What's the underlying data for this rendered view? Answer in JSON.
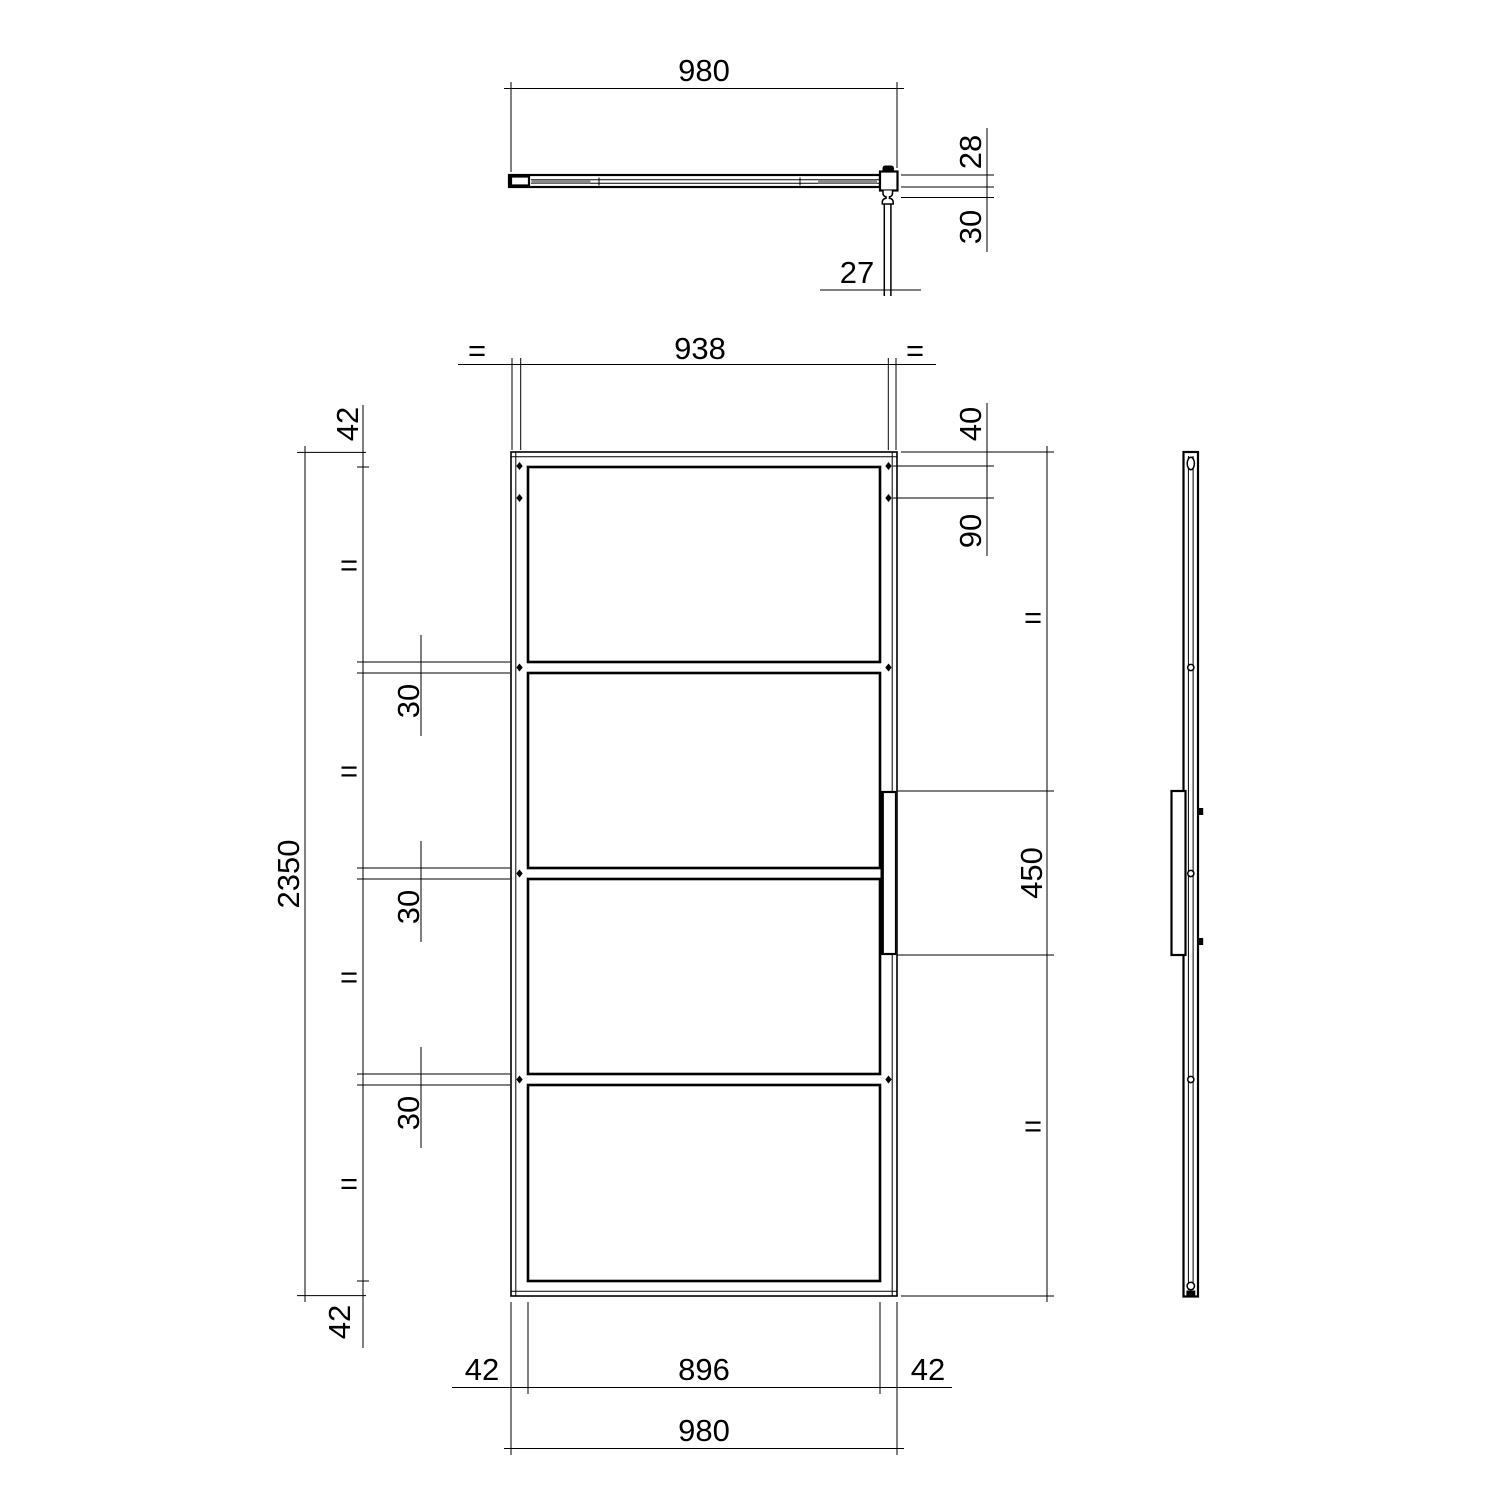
{
  "meta": {
    "background": "#ffffff",
    "line_color": "#000000",
    "profile_gray": "#888888"
  },
  "dims": {
    "top_width": "980",
    "door_thickness": "28",
    "handle_projection": "30",
    "handle_width": "27",
    "center_distance": "938",
    "profile_top": "42",
    "door_height": "2350",
    "rail_height": "30",
    "hanger_inset": "40",
    "hanger_spacing": "90",
    "handle_length": "450",
    "profile_bottom": "42",
    "stile_left": "42",
    "glass_width": "896",
    "stile_right": "42",
    "door_width": "980",
    "equal": "="
  }
}
